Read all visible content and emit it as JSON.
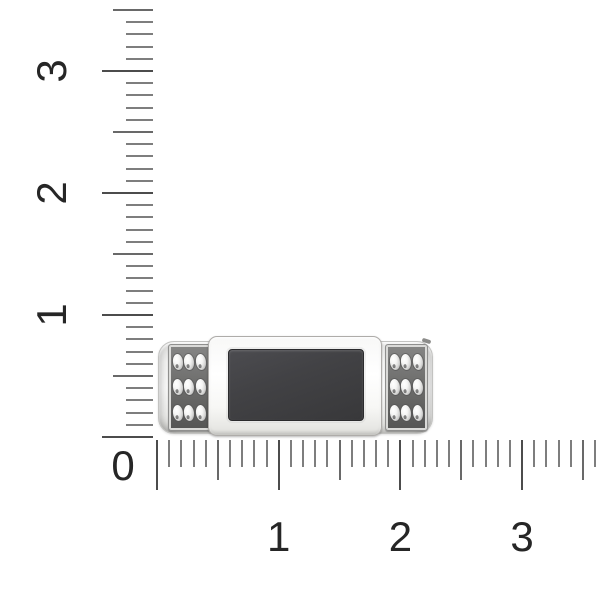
{
  "scene": {
    "background_color": "#ffffff"
  },
  "rulers": {
    "corner_label": "0",
    "colors": {
      "minor_tick": "#7e7e7e",
      "half_tick": "#696969",
      "major_tick": "#4c4c4c",
      "label": "#262626"
    },
    "horizontal": {
      "min": 0,
      "max": 3.6,
      "minor_step": 0.1,
      "half_step": 0.5,
      "major_step": 1,
      "labels": [
        {
          "text": "1",
          "value": 1
        },
        {
          "text": "2",
          "value": 2
        },
        {
          "text": "3",
          "value": 3
        }
      ]
    },
    "vertical": {
      "min": 0,
      "max": 3.5,
      "minor_step": 0.1,
      "half_step": 0.5,
      "major_step": 1,
      "labels": [
        {
          "text": "1",
          "value": 1
        },
        {
          "text": "2",
          "value": 2
        },
        {
          "text": "3",
          "value": 3
        }
      ]
    }
  },
  "product": {
    "kind": "ring-top-view",
    "body_color": "#f7f7f6",
    "stone_color": "#3e3e41",
    "side_panel_color": "#6b6b6a",
    "gem_color": "#efefee",
    "gem_grid_rows": 3,
    "gem_grid_cols": 3,
    "side_panel_count": 2
  }
}
